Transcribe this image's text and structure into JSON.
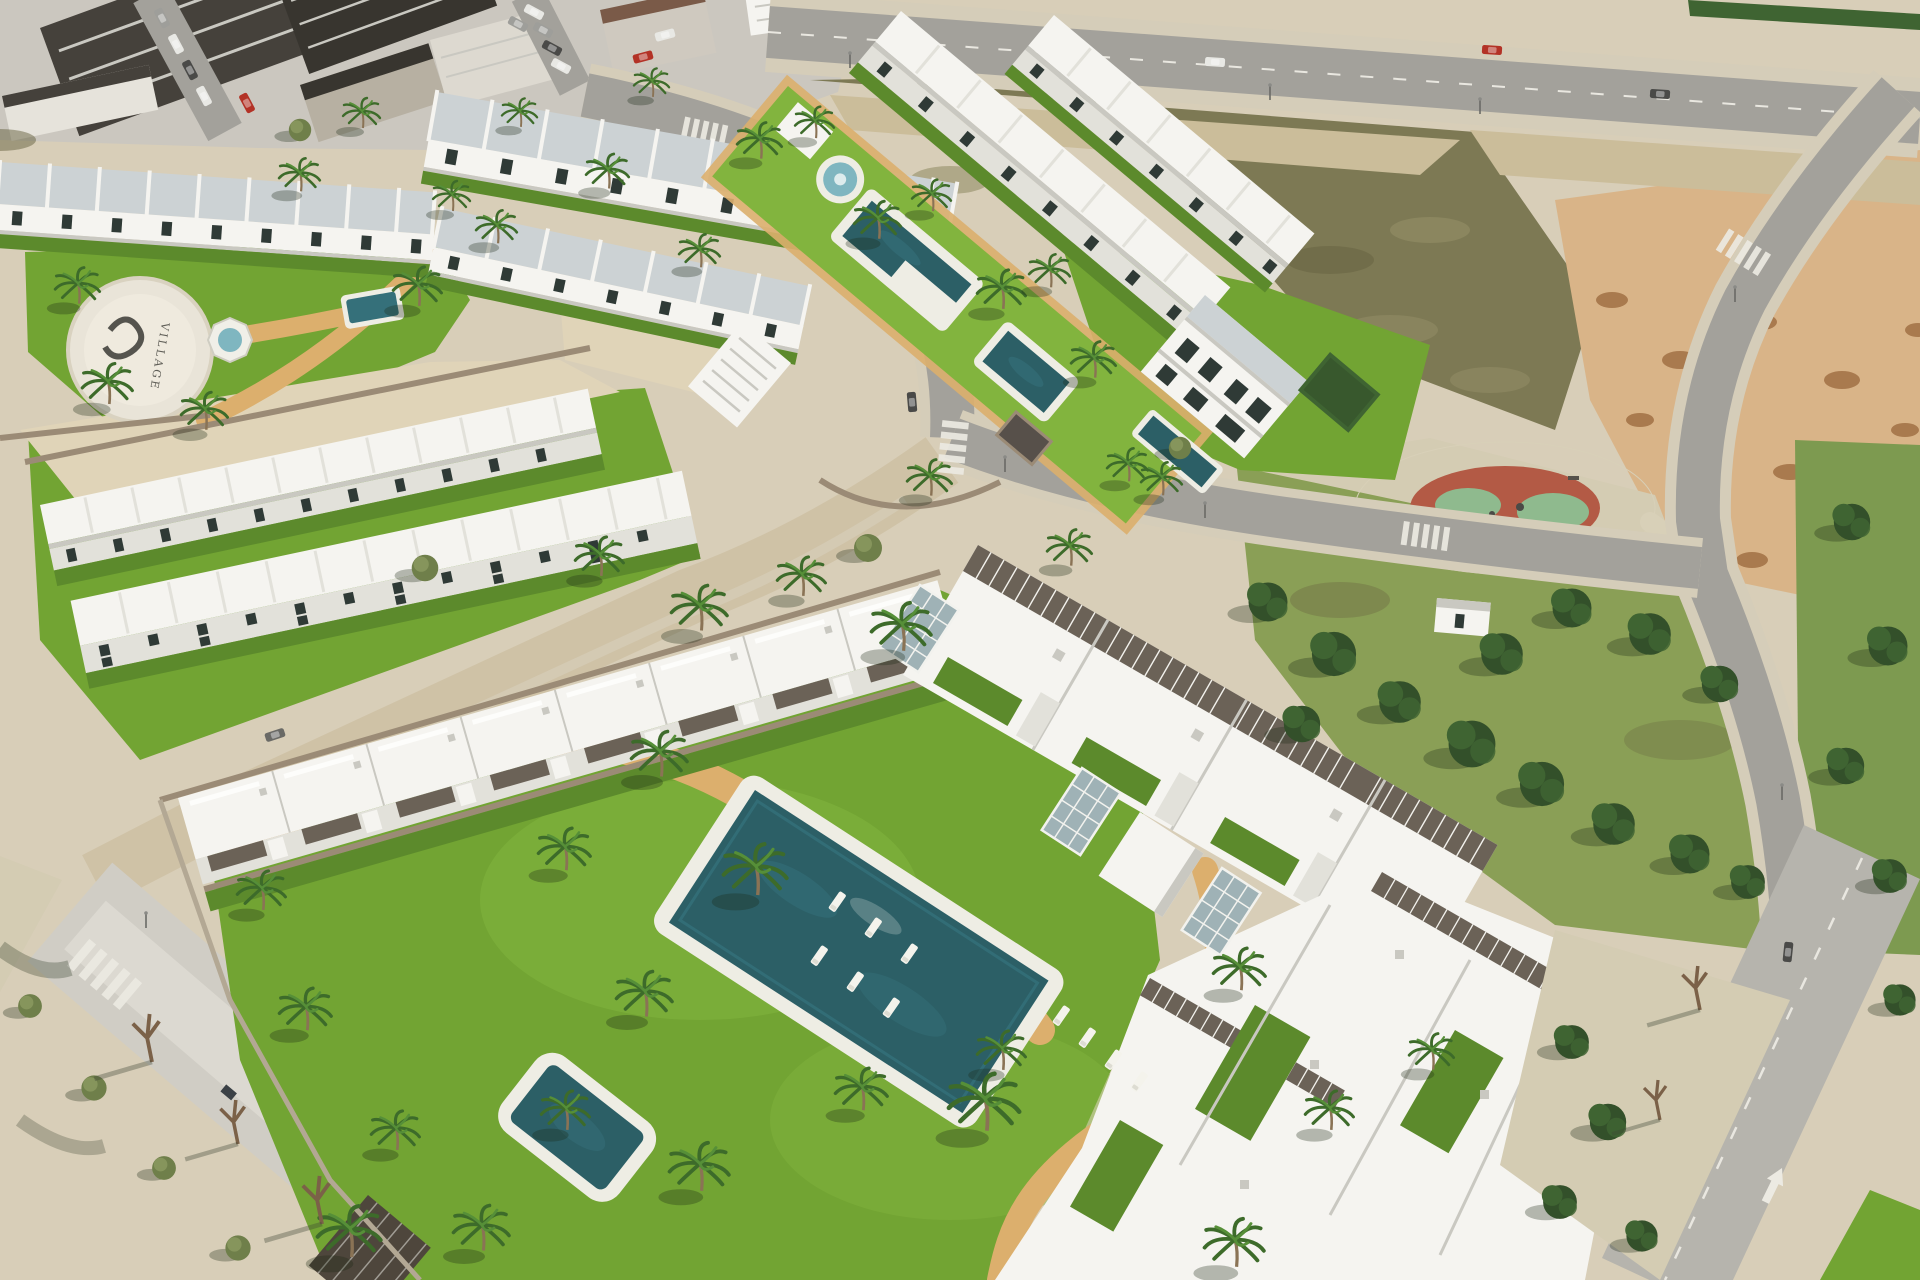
{
  "scene": {
    "type": "natural-image",
    "subject": "Aerial 3D architectural rendering of a new-build residential development",
    "description": "Bird's-eye render showing two phases of white modern townhouses and apartment blocks with communal lawns, swimming pools, sun loungers, palm trees and ochre sand paths. An existing town block with dark roofs and parked cars sits top-left, vacant scrubland plots with dirt piles top-right, a public park with mature pines and a circular red playground on the right, and asphalt / unfinished sand streets with crosswalks run between the plots.",
    "ground_logo_text": "VILLAGE",
    "regions": {
      "existing_town": "Dense town block, dark roofs, on-street parking",
      "phase_one": "Townhouse rows around gardens with logo plaza, fountain, lap pool and detached villa",
      "phase_two": "L-shaped complex around a big lawn with main pool, plunge pool and loungers",
      "park": "Public park with pine trees and circular playground",
      "vacant_lots": "Unbuilt scrub plot and excavated dirt with soil piles",
      "streets": "Perimeter roads with crosswalks, street lights and a painted lane arrow"
    },
    "counts": {
      "swimming_pools": 6,
      "playgrounds": 1,
      "sun_loungers": 10,
      "crosswalks": 5,
      "glass_skylights": 3
    }
  },
  "palette": {
    "ground": "#d8ceb8",
    "town_base": "#cbc7bf",
    "town_roof_dark": "#45413b",
    "town_roof_mid": "#38352f",
    "town_roof_brown": "#7a5a48",
    "road": "#a3a19b",
    "road_light": "#b6b4ad",
    "road_pale": "#d0cdc5",
    "sidewalk": "#d5cdb9",
    "sand_street": "#cfc2a6",
    "grass": "#72a433",
    "grass_light": "#82b43e",
    "grass_dark": "#5c8a2c",
    "park_grass": "#8a9f56",
    "park_grass2": "#7d9a50",
    "scrub": "#7d7954",
    "scrub_light": "#958f68",
    "scrub_dark": "#66623f",
    "dirt": "#d9b488",
    "dirt_pile": "#a97a4e",
    "sand": "#cbbd9a",
    "sand2": "#e0d4b8",
    "pavement": "#d4ccb3",
    "path_sand": "#dcaf6d",
    "path_pale": "#d8d0b8",
    "building_white": "#f5f4f0",
    "building_shade": "#e2e1da",
    "building_shadow": "#c9c8c1",
    "roof_panel": "#ccd2d4",
    "pergola": "#6b6257",
    "pergola_dark": "#4e463c",
    "window_glass": "#2f3a36",
    "stone_wall": "#9b8b76",
    "pool_deep": "#2c5f66",
    "pool_mid": "#35707a",
    "pool_light": "#7fb6c0",
    "deck": "#eeede4",
    "palm_dark": "#3d6b2a",
    "palm_light": "#568f38",
    "trunk": "#8a7355",
    "tree_dark": "#33502a",
    "tree_mid": "#3f6432",
    "olive_tree": "#6f7f4a",
    "olive_tree2": "#86955c",
    "playground_red": "#b35a45",
    "playground_green": "#8fba8e",
    "car_red": "#b33226",
    "car_gray": "#9e9e9a",
    "car_dark": "#4a4a48",
    "car_white": "#e8e8e4",
    "logo_dark": "#3a3a35"
  }
}
